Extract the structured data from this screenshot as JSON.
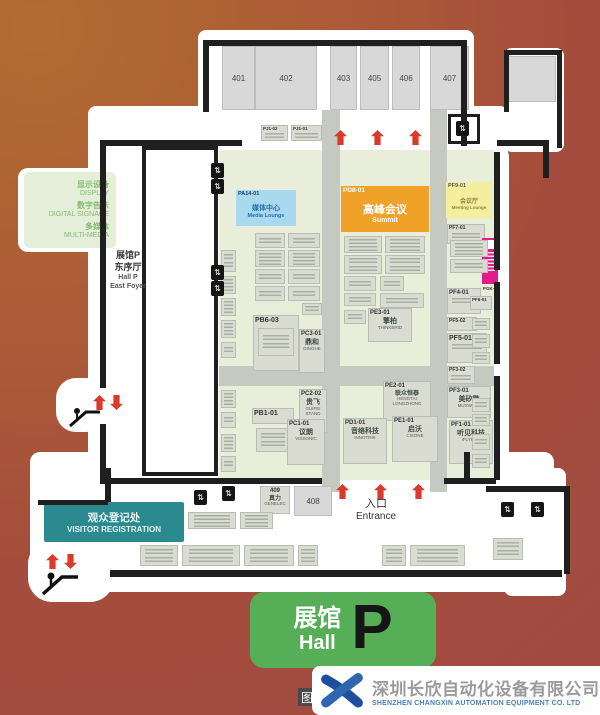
{
  "legend": {
    "rows": [
      {
        "cn": "显示设备",
        "en": "DISPLAY"
      },
      {
        "cn": "数字告示",
        "en": "DIGITAL SIGNAGE"
      },
      {
        "cn": "多媒体",
        "en": "MULTI-MEDIA"
      }
    ]
  },
  "top_rooms": [
    "401",
    "402",
    "403",
    "405",
    "406",
    "407"
  ],
  "foyer": {
    "cn1": "展馆P",
    "cn2": "东序厅",
    "en1": "Hall P",
    "en2": "East Foyer"
  },
  "features": {
    "media_lounge": {
      "code": "PA14-01",
      "cn": "媒体中心",
      "en": "Media Lounge"
    },
    "summit": {
      "code": "PD8-01",
      "cn": "高峰会议",
      "en": "Summit"
    },
    "meeting_lounge": {
      "code": "PF9-01",
      "cn": "会议厅",
      "en": "Meeting Lounge"
    },
    "visitor_registration": {
      "cn": "观众登记处",
      "en": "VISITOR REGISTRATION"
    },
    "entrance": {
      "cn": "入口",
      "en": "Entrance"
    },
    "room_409": {
      "code": "409",
      "cn": "真力",
      "en": "GENELEC"
    },
    "room_408": {
      "code": "408"
    }
  },
  "booths": {
    "pj1_02": {
      "code": "PJ1-02"
    },
    "pj1_01": {
      "code": "PJ1-01"
    },
    "pb6_03": {
      "code": "PB6-03"
    },
    "pc3_01": {
      "code": "PC3-01",
      "cn": "鼎和",
      "en": "DINGHE"
    },
    "pe3_01": {
      "code": "PE3-01",
      "cn": "擎柏",
      "en": "THINKBRID"
    },
    "pc2_02": {
      "code": "PC2-02",
      "cn": "贵飞",
      "en": "GUIFEI STAND"
    },
    "pe2_01": {
      "code": "PE2-01",
      "cn": "联众恒泰",
      "en": "HENGTAI LONGZHONG"
    },
    "pb1_01": {
      "code": "PB1-01"
    },
    "pc1_01": {
      "code": "PC1-01",
      "cn": "议朗",
      "en": "VISSONIC"
    },
    "pd1_01": {
      "code": "PD1-01",
      "cn": "音络科技",
      "en": "INNOTRIK"
    },
    "pe1_01": {
      "code": "PE1-01",
      "cn": "启沃",
      "en": "CISONE"
    },
    "pf7_01": {
      "code": "PF7-01"
    },
    "pf4_01": {
      "code": "PF4-01"
    },
    "pf6_01": {
      "code": "PF6-01"
    },
    "pf5_02": {
      "code": "PF5-02"
    },
    "pf5_01": {
      "code": "PF5-01"
    },
    "pf3_02": {
      "code": "PF3-02"
    },
    "pf3_01": {
      "code": "PF3-01",
      "cn": "美矽微",
      "en": "MUXWAVE"
    },
    "pf1_01": {
      "code": "PF1-01",
      "cn": "听见科技",
      "en": "iFLYREC"
    },
    "pgk_02": {
      "code": "PGK-02"
    }
  },
  "hall_sign": {
    "cn": "展馆",
    "en": "Hall",
    "letter": "P"
  },
  "footer": {
    "company_cn": "深圳长欣自动化设备有限公司",
    "company_en": "SHENZHEN CHANGXIN AUTOMATION EQUIPMENT CO. LTD",
    "watermark": "图"
  },
  "colors": {
    "bg1": "#b26c31",
    "bg2": "#ad5d36",
    "bg3": "#a44c3d",
    "bg4": "#a04a42",
    "floor": "#e9eedb",
    "aisle": "#c5c9bf",
    "booth": "#dadcd2",
    "boothBorder": "#b9beb2",
    "room": "#d8d8d8",
    "wall": "#1f1f1f",
    "blue": "#a9d9ee",
    "orange": "#f0a127",
    "yellow": "#f5ee9d",
    "teal": "#2b8a90",
    "green": "#56ae57",
    "legendBg": "#e4eed8",
    "legendText": "#86bb74",
    "red": "#d93a2b",
    "magenta": "#e31c8c",
    "logoBlue": "#1d4f9e",
    "footerCn": "#9b9b9b",
    "footerEn": "#4a7fc1"
  }
}
